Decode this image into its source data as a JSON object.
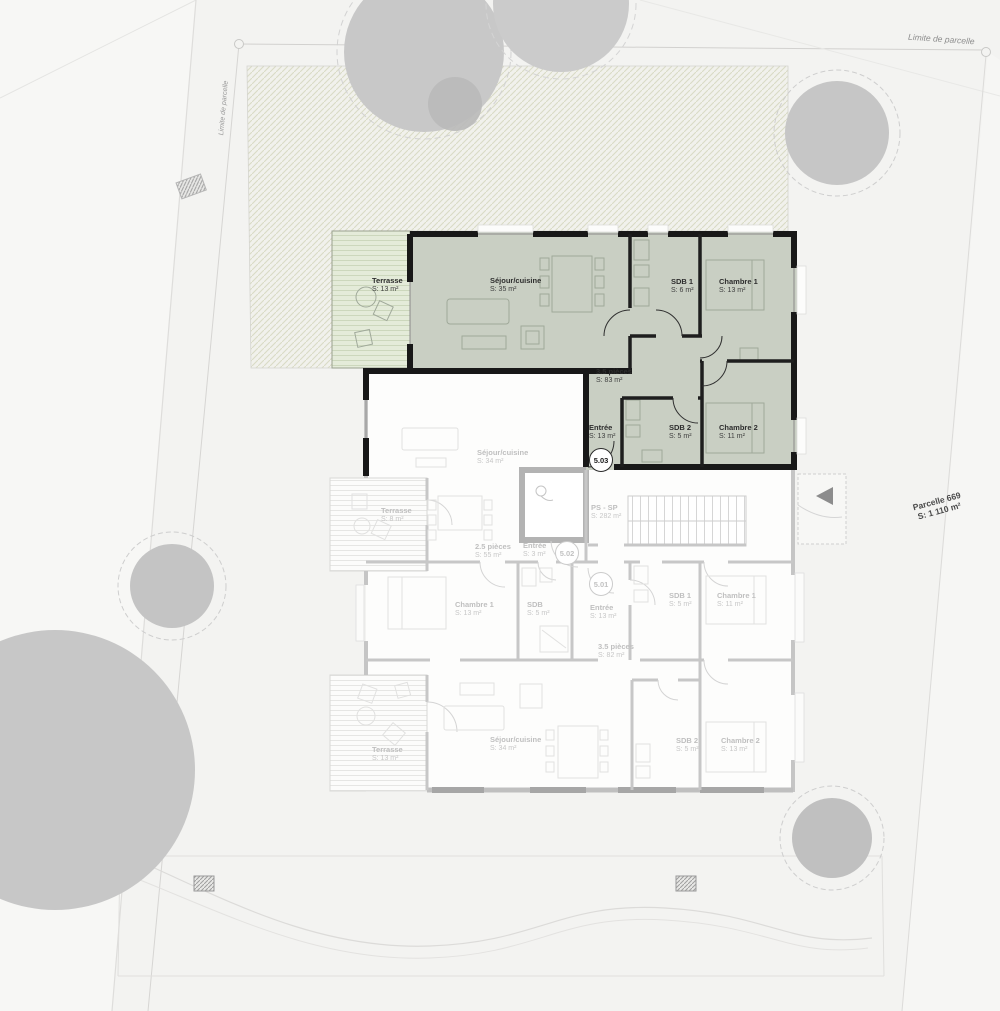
{
  "site": {
    "limite_top": "Limite de parcelle",
    "limite_left": "Limite de parcelle",
    "parcel": {
      "name": "Parcelle 669",
      "area": "S: 1 110 m²"
    }
  },
  "common_area": {
    "name": "PS - SP",
    "area": "S: 282 m²"
  },
  "apartments": {
    "a503": {
      "badge": "5.03",
      "type": "3.5 pièces",
      "type_area": "S: 83 m²",
      "terrasse_name": "Terrasse",
      "terrasse_area": "S: 13 m²",
      "sejour_name": "Séjour/cuisine",
      "sejour_area": "S: 35 m²",
      "sdb1_name": "SDB 1",
      "sdb1_area": "S: 6 m²",
      "chambre1_name": "Chambre 1",
      "chambre1_area": "S: 13 m²",
      "entree_name": "Entrée",
      "entree_area": "S: 13 m²",
      "sdb2_name": "SDB 2",
      "sdb2_area": "S: 5 m²",
      "chambre2_name": "Chambre 2",
      "chambre2_area": "S: 11 m²"
    },
    "a502": {
      "badge": "5.02",
      "type": "2.5 pièces",
      "type_area": "S: 55 m²",
      "sejour_name": "Séjour/cuisine",
      "sejour_area": "S: 34 m²",
      "terrasse_name": "Terrasse",
      "terrasse_area": "S: 8 m²",
      "entree_name": "Entrée",
      "entree_area": "S: 3 m²",
      "chambre1_name": "Chambre 1",
      "chambre1_area": "S: 13 m²",
      "sdb_name": "SDB",
      "sdb_area": "S: 5 m²"
    },
    "a501": {
      "badge": "5.01",
      "type": "3.5 pièces",
      "type_area": "S: 82 m²",
      "entree_name": "Entrée",
      "entree_area": "S: 13 m²",
      "sdb1_name": "SDB 1",
      "sdb1_area": "S: 5 m²",
      "chambre1_name": "Chambre 1",
      "chambre1_area": "S: 11 m²",
      "sdb2_name": "SDB 2",
      "sdb2_area": "S: 5 m²",
      "chambre2_name": "Chambre 2",
      "chambre2_area": "S: 13 m²",
      "sejour_name": "Séjour/cuisine",
      "sejour_area": "S: 34 m²",
      "terrasse_name": "Terrasse",
      "terrasse_area": "S: 13 m²"
    }
  },
  "colors": {
    "active_unit_fill": "#c9cfc3",
    "active_terrace_fill": "#e4ebd9",
    "active_wall": "#181818",
    "inactive_wall": "#c5c5c5",
    "garden_hatch_line": "#d9dbc5",
    "tree_fill": "#c8c8c8"
  }
}
